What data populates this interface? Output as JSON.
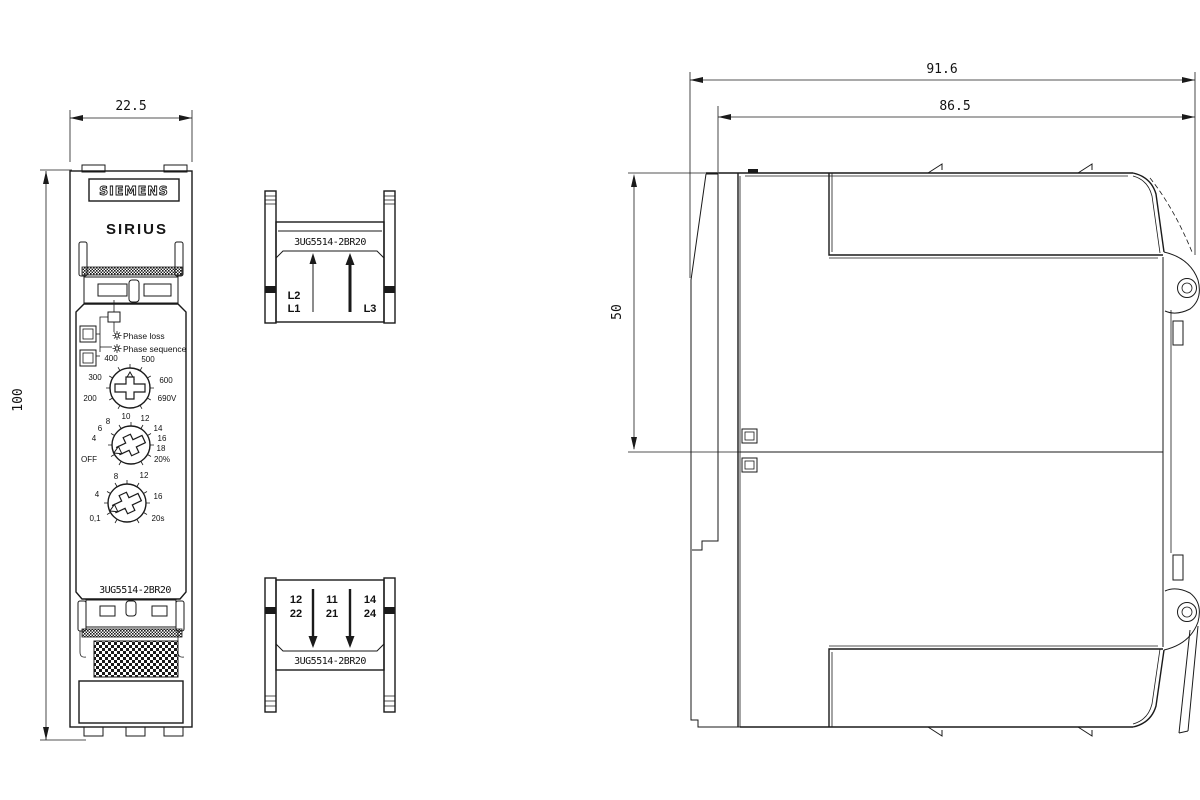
{
  "labels": {
    "brand": "SIEMENS",
    "series": "SIRIUS"
  },
  "dimensions": {
    "width_front": "22.5",
    "height_front": "100",
    "depth_total": "91.6",
    "depth_body": "86.5",
    "recess_depth": "50"
  },
  "front": {
    "product_code": "3UG5514-2BR20",
    "indicators": {
      "led1": "Phase loss",
      "led2": "Phase sequence"
    },
    "dial_voltage": {
      "labels": [
        "400",
        "500",
        "300",
        "600",
        "200",
        "690V"
      ]
    },
    "dial_asymmetry": {
      "labels": [
        "OFF",
        "4",
        "6",
        "8",
        "10",
        "12",
        "14",
        "16",
        "18",
        "20%"
      ]
    },
    "dial_delay": {
      "labels": [
        "0,1",
        "4",
        "8",
        "12",
        "16",
        "20s"
      ]
    }
  },
  "terminal_block_top": {
    "product_code": "3UG5514-2BR20",
    "phase_labels": {
      "l2": "L2",
      "l1": "L1",
      "l3": "L3"
    }
  },
  "terminal_block_bottom": {
    "product_code": "3UG5514-2BR20",
    "no_row": [
      "12",
      "11",
      "14"
    ],
    "nc_row": [
      "22",
      "21",
      "24"
    ]
  }
}
